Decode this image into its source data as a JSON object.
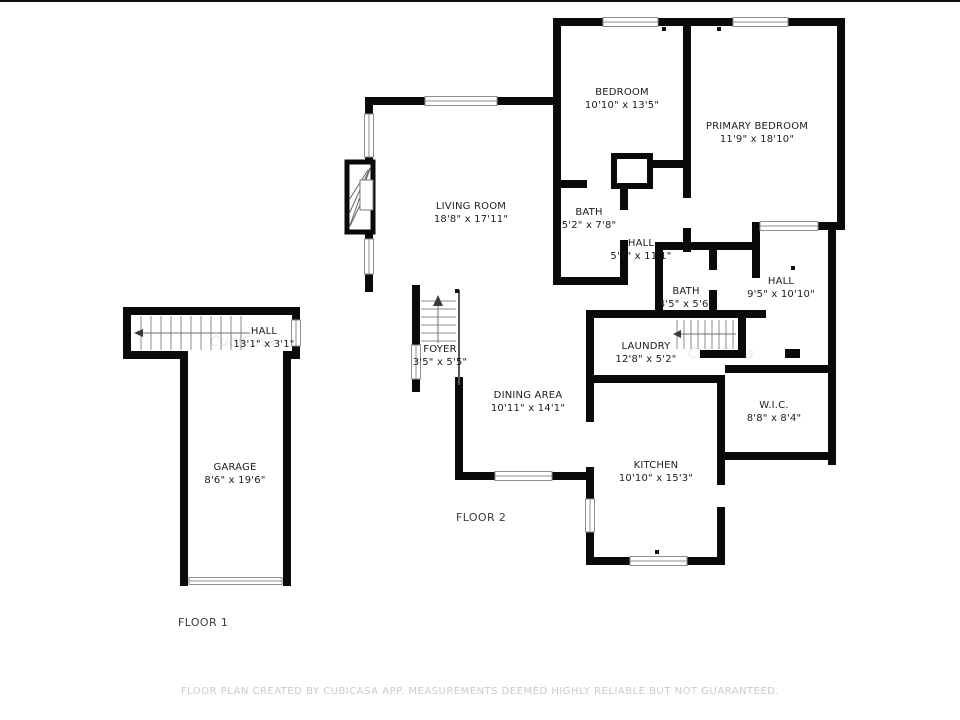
{
  "rooms": {
    "bedroom": {
      "name": "BEDROOM",
      "dims": "10'10\" x 13'5\""
    },
    "primary_bedroom": {
      "name": "PRIMARY BEDROOM",
      "dims": "11'9\" x 18'10\""
    },
    "living_room": {
      "name": "LIVING ROOM",
      "dims": "18'8\" x 17'11\""
    },
    "bath_upper": {
      "name": "BATH",
      "dims": "5'2\" x 7'8\""
    },
    "hall_upper": {
      "name": "HALL",
      "dims": "5'7\" x 11'1\""
    },
    "bath_middle": {
      "name": "BATH",
      "dims": "4'5\" x 5'6\""
    },
    "hall_right": {
      "name": "HALL",
      "dims": "9'5\" x 10'10\""
    },
    "laundry": {
      "name": "LAUNDRY",
      "dims": "12'8\" x 5'2\""
    },
    "foyer": {
      "name": "FOYER",
      "dims": "3'5\" x 5'5\""
    },
    "dining_area": {
      "name": "DINING AREA",
      "dims": "10'11\" x 14'1\""
    },
    "kitchen": {
      "name": "KITCHEN",
      "dims": "10'10\" x 15'3\""
    },
    "wic": {
      "name": "W.I.C.",
      "dims": "8'8\" x 8'4\""
    },
    "hall_floor1": {
      "name": "HALL",
      "dims": "13'1\" x 3'1\""
    },
    "garage": {
      "name": "GARAGE",
      "dims": "8'6\" x 19'6\""
    }
  },
  "floor_labels": {
    "floor1": "FLOOR 1",
    "floor2": "FLOOR 2"
  },
  "watermark": "CubiCasa",
  "footer": {
    "disclaimer": "FLOOR PLAN CREATED BY CUBICASA APP. MEASUREMENTS DEEMED HIGHLY RELIABLE BUT NOT GUARANTEED."
  },
  "colors": {
    "wall": "#0a0a0a",
    "text": "#1c1c1c",
    "footer_text": "#cbcbcb"
  }
}
